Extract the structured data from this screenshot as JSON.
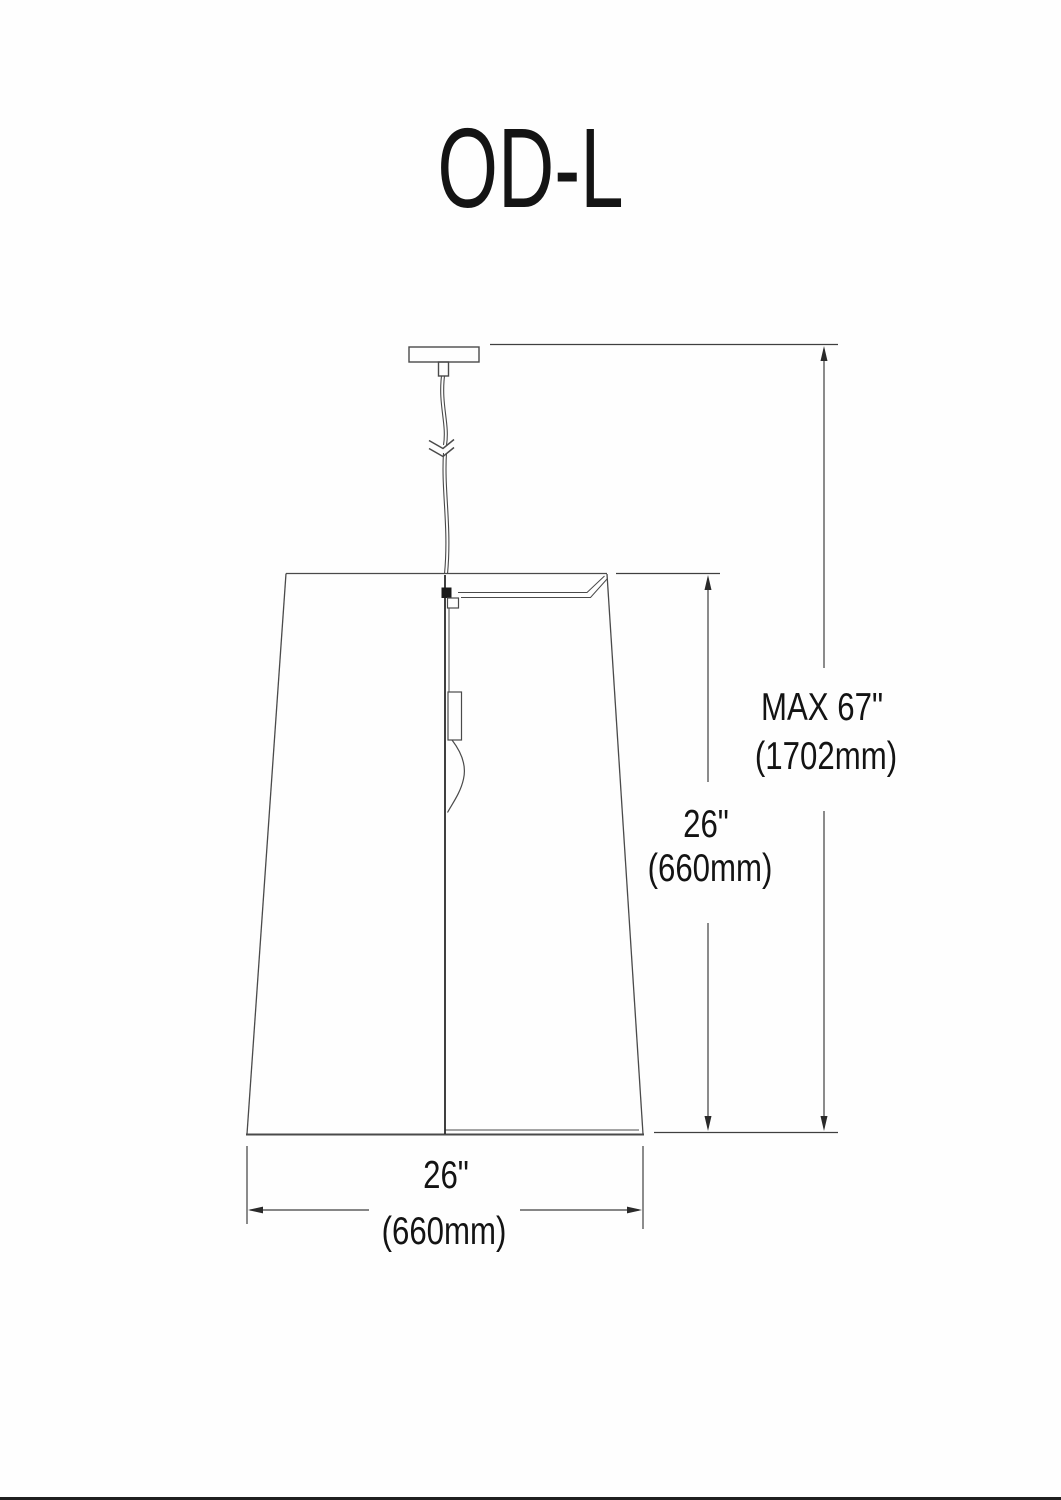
{
  "title": "OD-L",
  "dimensions": {
    "overall_height": {
      "imperial": "MAX 67\"",
      "metric": "(1702mm)"
    },
    "shade_height": {
      "imperial": "26\"",
      "metric": "(660mm)"
    },
    "shade_width": {
      "imperial": "26\"",
      "metric": "(660mm)"
    }
  },
  "colors": {
    "background": "#fefefe",
    "line": "#3f3f3f",
    "text": "#131313"
  }
}
